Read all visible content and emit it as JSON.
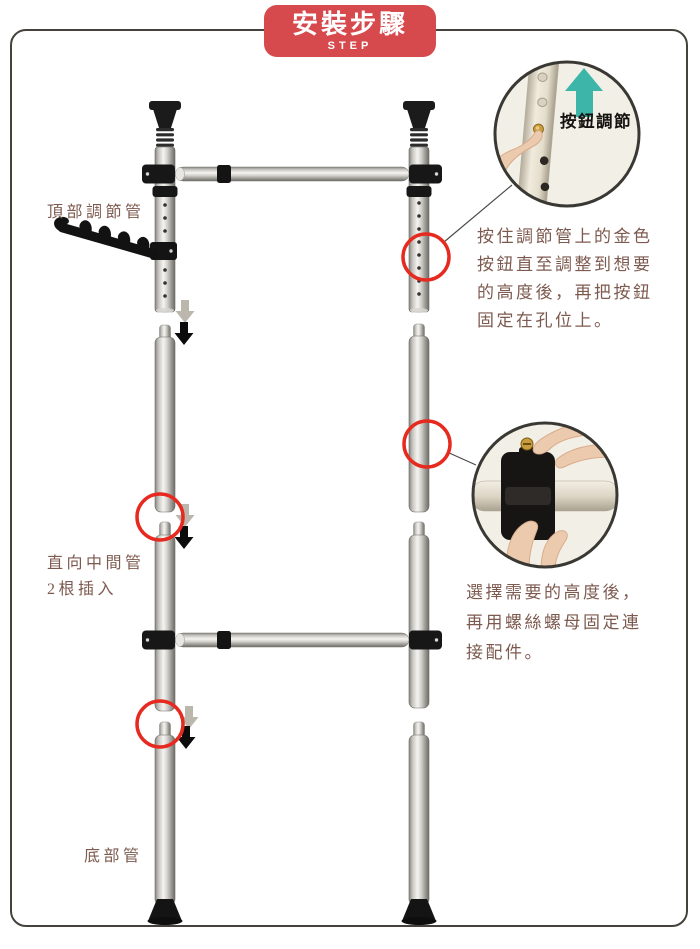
{
  "banner": {
    "title": "安裝步驟",
    "subtitle": "STEP",
    "bg_color": "#d6494c",
    "text_color": "#ffffff"
  },
  "frame": {
    "border_color": "#45423c"
  },
  "labels": {
    "top_tube": "頂部調節管",
    "middle_tube_line1": "直向中間管",
    "middle_tube_line2": "2根插入",
    "bottom_tube": "底部管",
    "text_color": "#7d5a4f"
  },
  "callouts": {
    "button_adjust": {
      "caption": "按鈕調節",
      "lines": [
        "按住調節管上的金色",
        "按鈕直至調整到想要",
        "的高度後，再把按鈕",
        "固定在孔位上。"
      ]
    },
    "screw_fix": {
      "lines": [
        "選擇需要的高度後，",
        "再用螺絲螺母固定連",
        "接配件。"
      ]
    }
  },
  "colors": {
    "highlight_circle_red": "#e62a1f",
    "insert_arrow_black": "#0c0c0c",
    "insert_arrow_gray": "#bcb7ac",
    "adjust_arrow_teal": "#3db6a9",
    "gold_button": "#c89c3e",
    "pole_metal_light": "#f5f4f1",
    "pole_metal_dark": "#6e6c66",
    "fitting_black": "#141414"
  },
  "icons": {
    "up_arrow": "teal-up-arrow",
    "down_arrows": "insert-direction-arrows",
    "circle_highlight": "red-circle-highlight",
    "hook_bracket": "five-hook-hanger-arm"
  }
}
